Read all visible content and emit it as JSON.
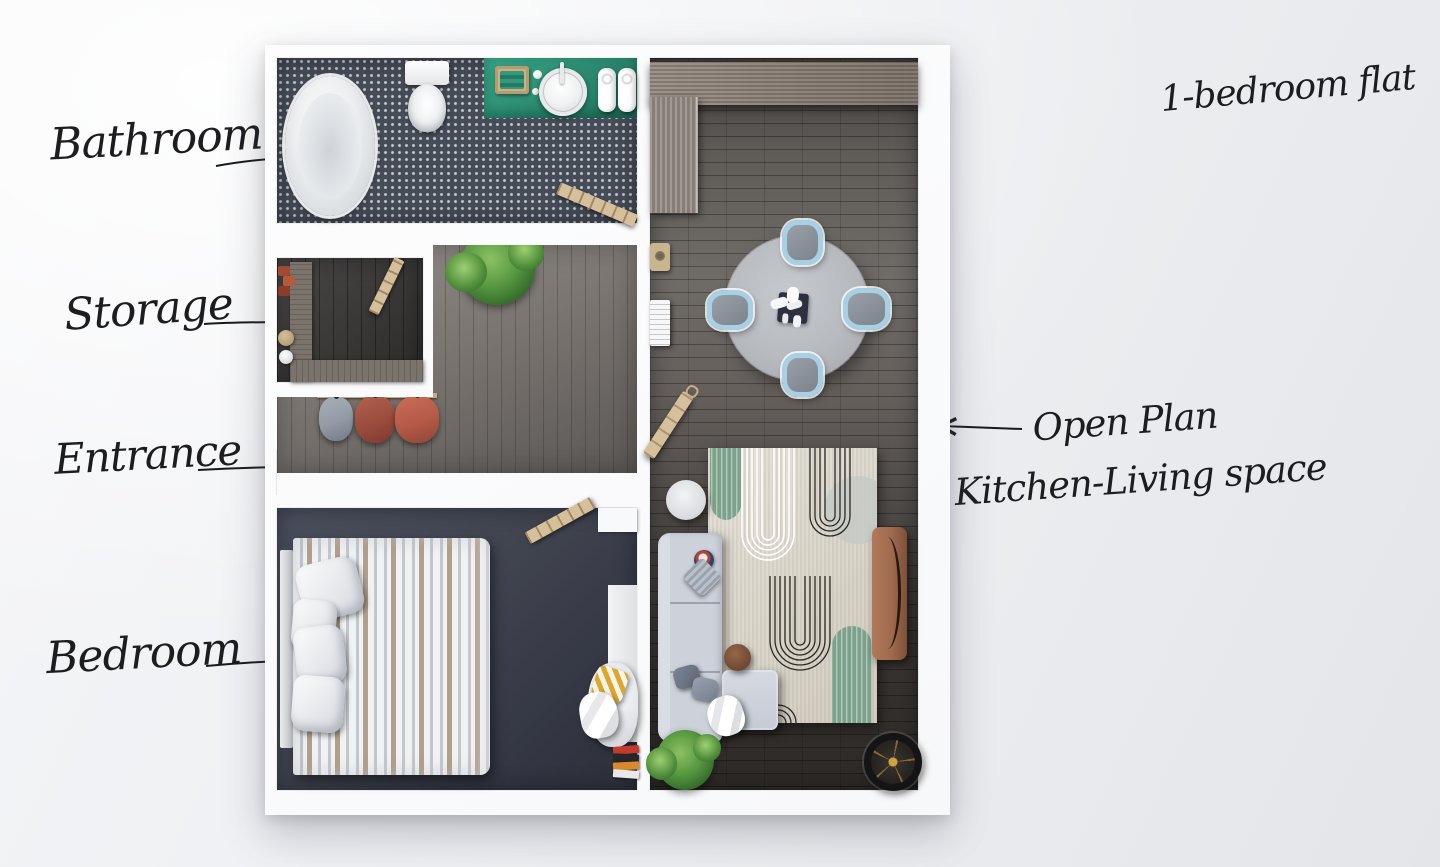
{
  "title": "1-bedroom flat",
  "annotations": {
    "bathroom": {
      "label": "Bathroom",
      "arrow": "points-right-to-bathtub"
    },
    "storage": {
      "label": "Storage",
      "arrow": "points-right-to-storage-room"
    },
    "entrance": {
      "label": "Entrance",
      "arrow": "points-right-to-entry-door"
    },
    "bedroom": {
      "label": "Bedroom",
      "arrow": "points-right-to-bed"
    },
    "open_plan": {
      "label_line1": "Open Plan",
      "label_line2": "Kitchen-Living space",
      "arrow": "points-left-to-living-room"
    }
  },
  "plan": {
    "type": "apartment-floor-plan-top-view",
    "rooms": [
      "Bathroom",
      "Storage",
      "Entrance hallway",
      "Bedroom",
      "Open Plan Kitchen-Living space"
    ],
    "furniture": [
      "bathtub",
      "toilet",
      "vessel-sink",
      "towels",
      "coat-rack",
      "potted-plant",
      "double-bed",
      "pillows",
      "armchair",
      "ladder-shelf",
      "kitchen-counter",
      "dining-table",
      "dining-chairs",
      "area-rug",
      "sofa",
      "side-table",
      "pouf",
      "tv-console",
      "floor-lamp"
    ]
  },
  "colors": {
    "ink": "#1d1d20",
    "wall": "#f7f8fa",
    "teal_mat": "#2e8f74",
    "chair_blue": "#a7d0e4",
    "rug_cream": "#ded9cc",
    "rug_green": "#7da28c",
    "sofa_gray": "#cdd1da",
    "coat_gray": "#929aa5",
    "coat_dark_red": "#9c4c3e",
    "coat_red": "#b55a47",
    "wood_light": "#d5c09b",
    "kitchen_wood": "#8b7f75",
    "tv_brown": "#a06a4e",
    "lamp_gold": "#cfa43e",
    "pillow_yellow": "#dca62f",
    "plant_green": "#55963f"
  }
}
